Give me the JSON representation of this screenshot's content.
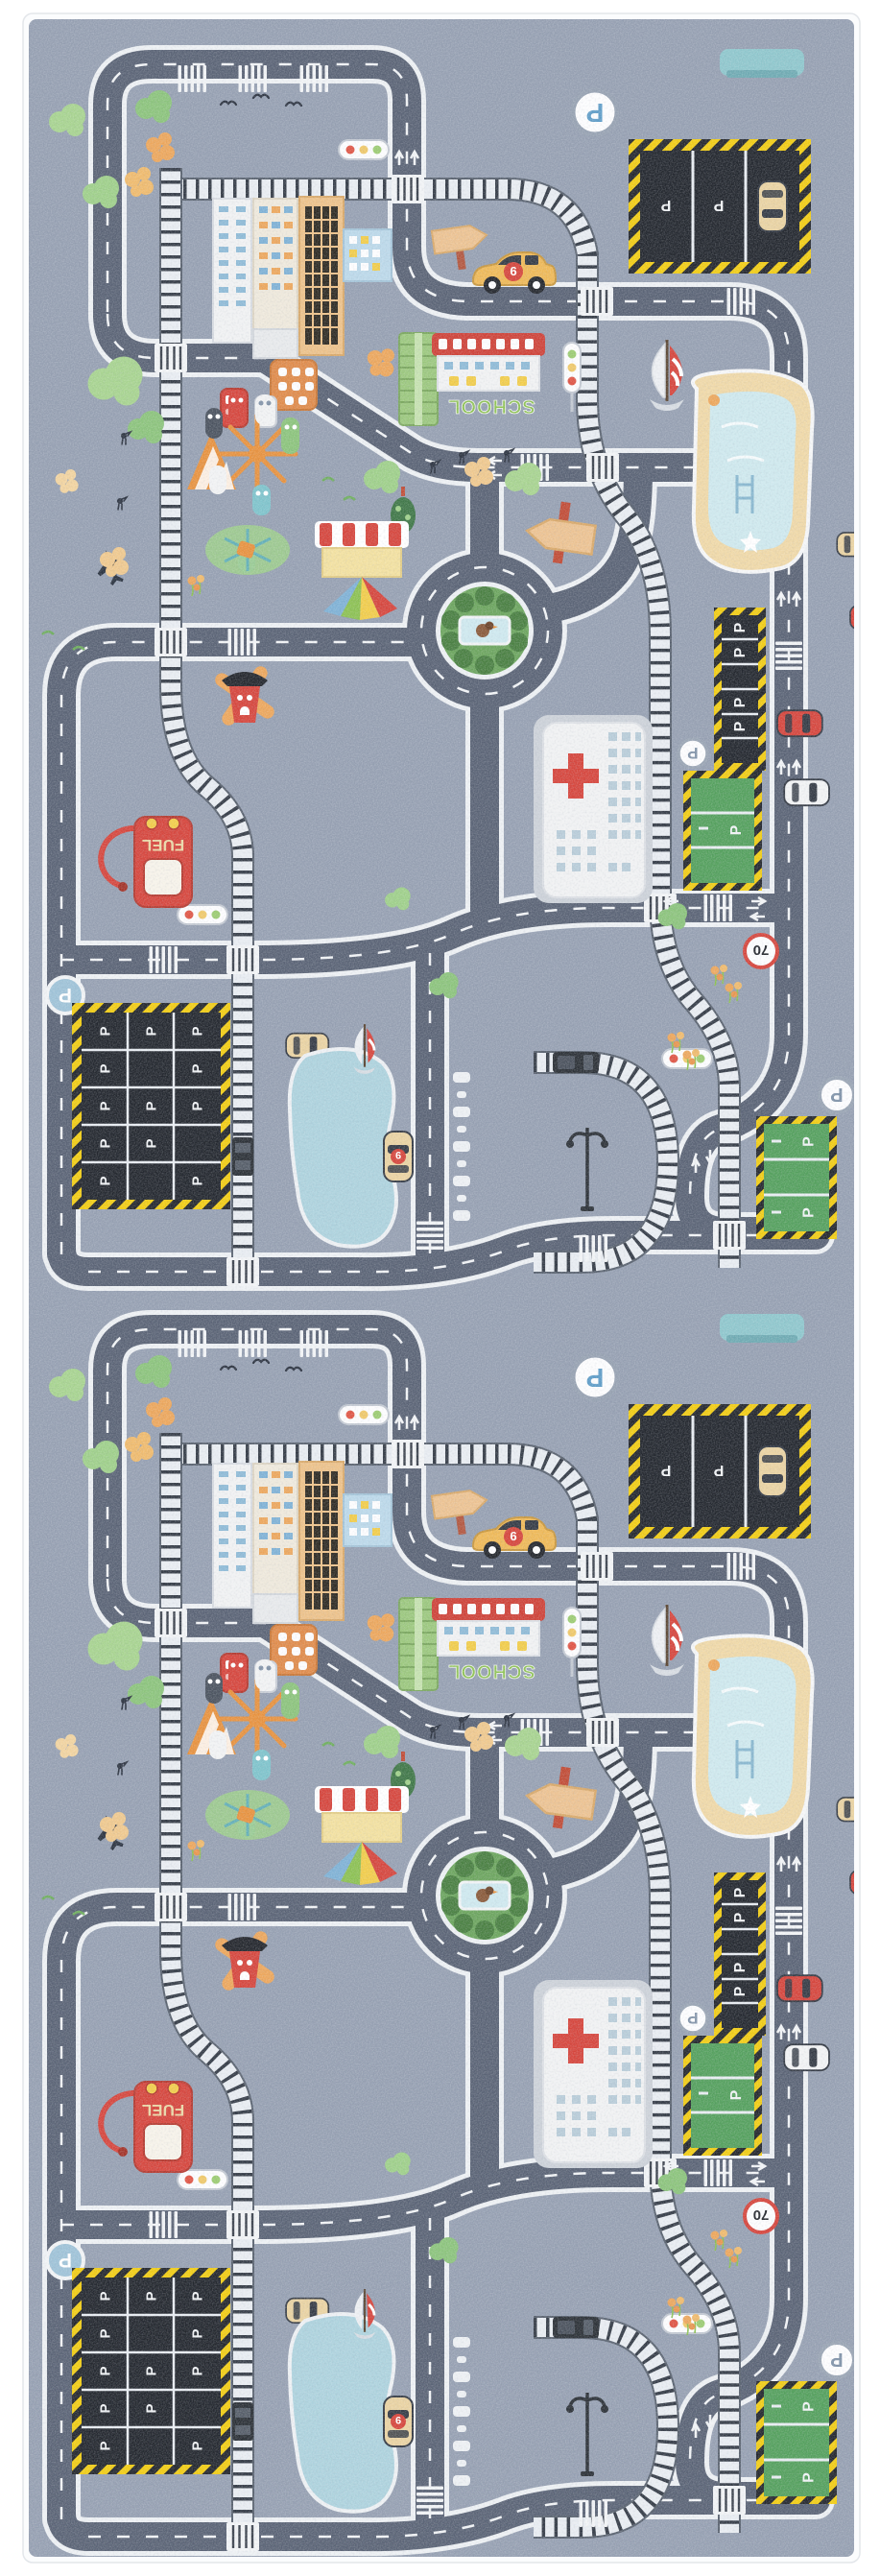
{
  "scene": {
    "type": "product-photo",
    "subject": "Children's city road play rug (runner), design repeated twice lengthwise",
    "background_color": "#ffffff"
  },
  "rug": {
    "tiles": 2,
    "palette": {
      "base": "#96a0b2",
      "binding": "#fbfcfd",
      "road": "#5a6375",
      "road_line": "#f2f4f6",
      "rail_bed": "#e9edf2",
      "rail_tie": "#343b46",
      "hazard_yellow": "#f2cd13",
      "hazard_black": "#23262c",
      "lot_black": "#23272e",
      "lot_green": "#54a05d",
      "grass": "#6ca55e",
      "water": "#aed3de",
      "pool_deck": "#f0d9a8",
      "building_white": "#f1f2f3",
      "roof_red": "#cf4238",
      "accent_red": "#d6453c",
      "taxi_yellow": "#efb957",
      "car_beige": "#ead3a2",
      "tree_green": "#9fd08a",
      "tree_orange": "#eda75c",
      "sign_blue": "#5f9dc8"
    },
    "labels": {
      "school": "SCHOOL",
      "fuel": "FUEL",
      "speed_limit": "70",
      "parking": "P",
      "taxi_number": "9"
    },
    "features": [
      "roads with dashed lane markings and crosswalks",
      "railway tracks with crossings",
      "roundabout with bushes and duck pond",
      "school building",
      "hospital with red cross",
      "fuel station pump",
      "black parking lots with P stalls",
      "green parking lots",
      "swimming pool",
      "lake",
      "market stall with rainbow fan",
      "carousel playground with striped tent",
      "windmill",
      "traffic lights",
      "side-view taxi",
      "top-view parked cars",
      "train cars",
      "sail boats",
      "street lamp",
      "park bench",
      "trees, bushes and birds",
      "speed limit 70 sign",
      "round P parking signs"
    ]
  }
}
